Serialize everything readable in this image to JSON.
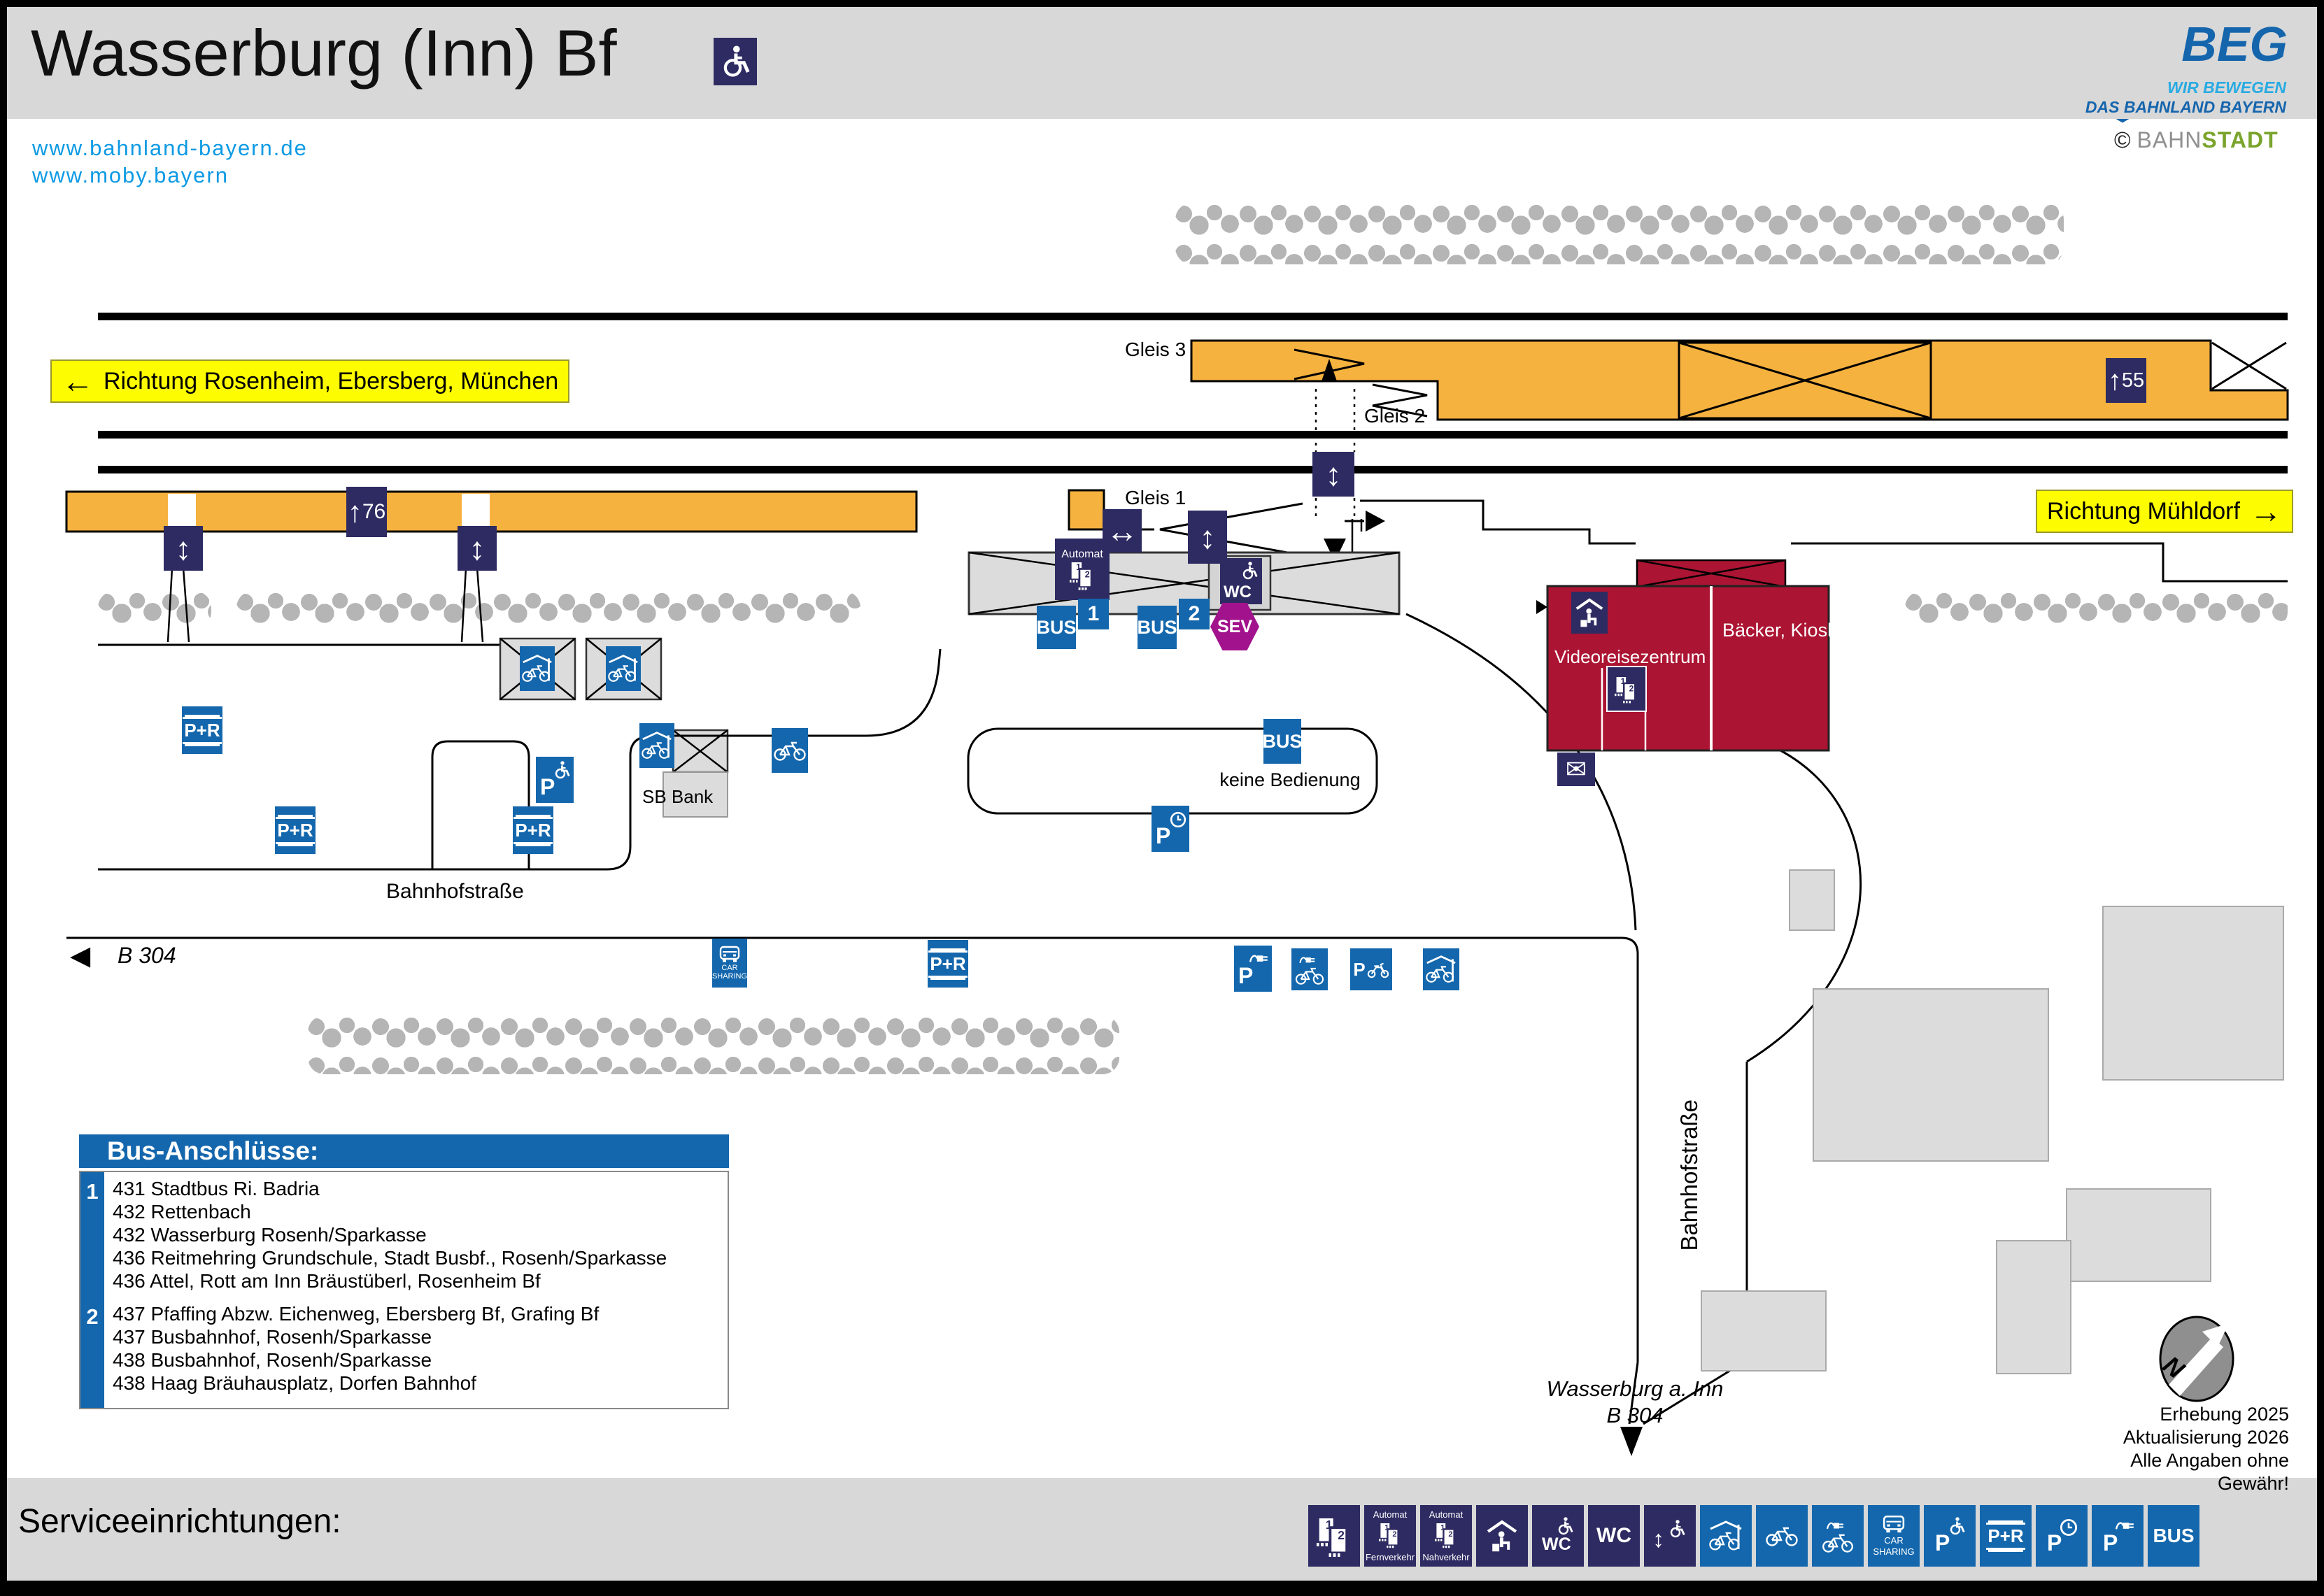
{
  "header": {
    "title": "Wasserburg (Inn) Bf",
    "links": [
      "www.bahnland-bayern.de",
      "www.moby.bayern"
    ],
    "logo": {
      "name": "BEG",
      "tagline1": "WIR BEWEGEN",
      "tagline2": "DAS BAHNLAND BAYERN"
    },
    "credit": {
      "sign": "©",
      "part1": "BAHN",
      "part2": "STADT"
    }
  },
  "map": {
    "direction_left": "Richtung Rosenheim, Ebersberg, München",
    "direction_right": "Richtung Mühldorf",
    "tracks": {
      "gleis1": "Gleis 1",
      "gleis2": "Gleis 2",
      "gleis3": "Gleis 3"
    },
    "platform_lengths": {
      "gleis1": "76",
      "gleis23": "55"
    },
    "labels": {
      "automat": "Automat",
      "wc": "WC",
      "bus": "BUS",
      "sev": "SEV",
      "bus_stop_1": "1",
      "bus_stop_2": "2",
      "keine_bedienung": "keine Bedienung",
      "sb_bank": "SB Bank",
      "videoreisezentrum": "Videoreisezentrum",
      "baecker_kiosk": "Bäcker, Kiosk",
      "pr": "P+R",
      "p": "P",
      "car_line1": "CAR",
      "car_line2": "SHARING",
      "bahnhofstrasse": "Bahnhofstraße",
      "b304": "B 304",
      "wasserburg": "Wasserburg a. Inn"
    },
    "icons": {
      "up_arrow": "↑",
      "left_arrow": "←",
      "right_arrow": "→",
      "left_triangle": "◀",
      "updown_arrow": "↕",
      "leftright_arrow": "↔",
      "envelope": "✉"
    },
    "note": {
      "line1": "Erhebung 2025",
      "line2": "Aktualisierung 2026",
      "line3": "Alle Angaben ohne Gewähr!"
    },
    "compass": "N"
  },
  "bus_connections": {
    "title": "Bus-Anschlüsse:",
    "stops": [
      {
        "stop": "1",
        "lines": [
          "431 Stadtbus Ri. Badria",
          "432 Rettenbach",
          "432 Wasserburg Rosenh/Sparkasse",
          "436 Reitmehring Grundschule, Stadt Busbf., Rosenh/Sparkasse",
          "436 Attel, Rott am Inn Bräustüberl, Rosenheim Bf"
        ]
      },
      {
        "stop": "2",
        "lines": [
          "437 Pfaffing Abzw. Eichenweg, Ebersberg Bf, Grafing Bf",
          "437 Busbahnhof, Rosenh/Sparkasse",
          "438 Busbahnhof, Rosenh/Sparkasse",
          "438 Haag Bräuhausplatz, Dorfen Bahnhof"
        ]
      }
    ]
  },
  "footer": {
    "title": "Serviceeinrichtungen:",
    "icons": [
      {
        "name": "ticket-counter-icon",
        "type": "counter"
      },
      {
        "name": "ticket-machine-longdistance-icon",
        "type": "ticket",
        "top": "Automat",
        "bottom": "Fernverkehr"
      },
      {
        "name": "ticket-machine-local-icon",
        "type": "ticket",
        "top": "Automat",
        "bottom": "Nahverkehr"
      },
      {
        "name": "waiting-room-icon",
        "type": "waiting"
      },
      {
        "name": "accessible-wc-icon",
        "type": "wc-wheelchair",
        "text": "WC"
      },
      {
        "name": "wc-icon",
        "type": "wc",
        "text": "WC"
      },
      {
        "name": "boarding-aid-icon",
        "type": "lift"
      },
      {
        "name": "covered-bike-parking-icon",
        "type": "bike-covered"
      },
      {
        "name": "bike-parking-icon",
        "type": "bike"
      },
      {
        "name": "ebike-charging-icon",
        "type": "bike-charge"
      },
      {
        "name": "car-sharing-icon",
        "type": "carsharing",
        "top": "CAR",
        "bottom": "SHARING"
      },
      {
        "name": "disabled-parking-icon",
        "type": "p-wheelchair",
        "text": "P"
      },
      {
        "name": "park-and-ride-icon",
        "type": "pr",
        "text": "P+R"
      },
      {
        "name": "short-term-parking-icon",
        "type": "p-clock",
        "text": "P"
      },
      {
        "name": "ev-charging-icon",
        "type": "p-charge",
        "text": "P"
      },
      {
        "name": "bus-icon",
        "type": "bus-text",
        "text": "BUS"
      }
    ]
  },
  "colors": {
    "navy": "#2e2b62",
    "blue": "#1467ad",
    "orange": "#f6b23f",
    "yellow": "#fdfc00",
    "red_building": "#ab1432",
    "sev_magenta": "#a2128c",
    "building_gray": "#dcdcdc",
    "link_blue": "#0d9ae4",
    "beg_dark": "#1565ad",
    "beg_light": "#29abe2",
    "bahnstadt_green": "#7aa42c"
  }
}
